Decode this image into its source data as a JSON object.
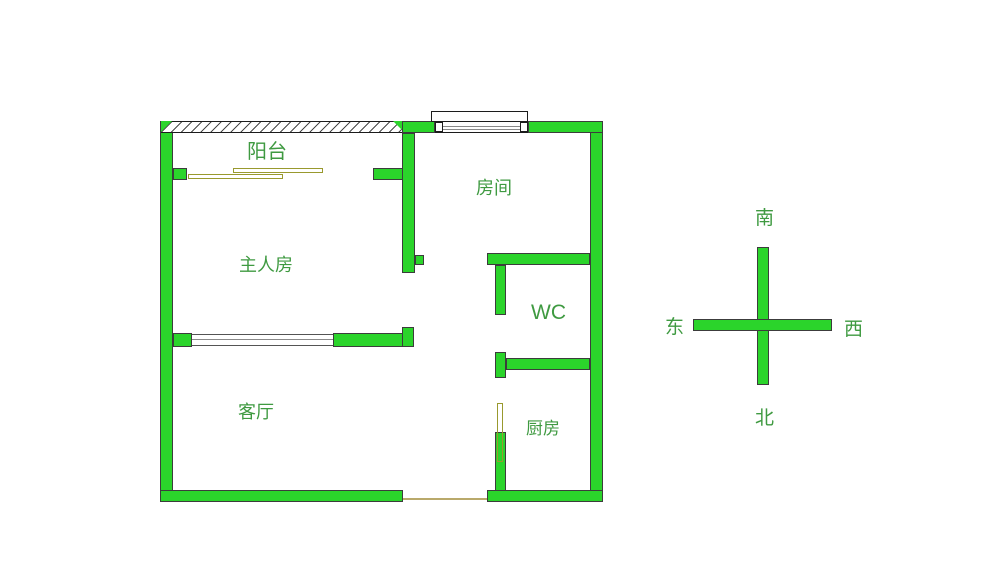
{
  "title": "apartment-floorplan",
  "rooms": {
    "balcony": {
      "label": "阳台"
    },
    "master_bedroom": {
      "label": "主人房"
    },
    "bedroom": {
      "label": "房间"
    },
    "wc": {
      "label": "WC"
    },
    "living_room": {
      "label": "客厅"
    },
    "kitchen": {
      "label": "厨房"
    }
  },
  "compass": {
    "top": "南",
    "bottom": "北",
    "left": "东",
    "right": "西"
  },
  "colors": {
    "wall_fill": "#2bd42b",
    "wall_outline": "#3c3c3c",
    "label_text": "#3f9a41",
    "door_outline": "#99992e",
    "threshold_line": "#b9a96b",
    "window_line": "#8a8a8a",
    "background": "#ffffff"
  }
}
